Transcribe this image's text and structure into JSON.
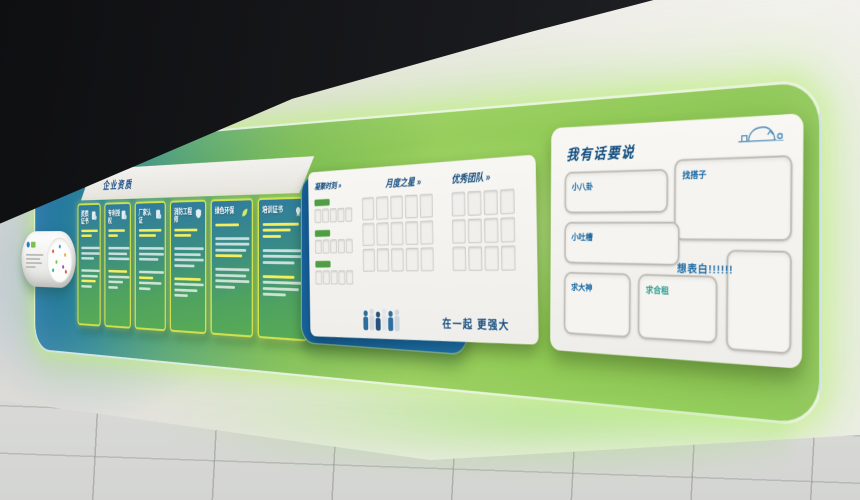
{
  "header": {
    "title": "企业资质"
  },
  "panels": [
    {
      "title": "资质证书"
    },
    {
      "title": "专利授权"
    },
    {
      "title": "厂家认证"
    },
    {
      "title": "消防工程师"
    },
    {
      "title": "绿色环保"
    },
    {
      "title": "培训证书"
    }
  ],
  "honor": {
    "col1": "凝聚时刻 »",
    "col2": "月度之星 »",
    "col3": "优秀团队 »",
    "slogan": "在一起 更强大"
  },
  "msg": {
    "title": "我有话要说",
    "cell_gossip": "小八卦",
    "cell_complaint": "小吐槽",
    "cell_master": "求大神",
    "cell_roommate": "求合租",
    "cell_partner": "找搭子",
    "callout": "想表白!!!!!!"
  },
  "colors": {
    "led_green": "#8cc84f",
    "deep_blue": "#1e6fa6",
    "neon_border": "#d3e94e",
    "text_blue": "#14507e"
  }
}
